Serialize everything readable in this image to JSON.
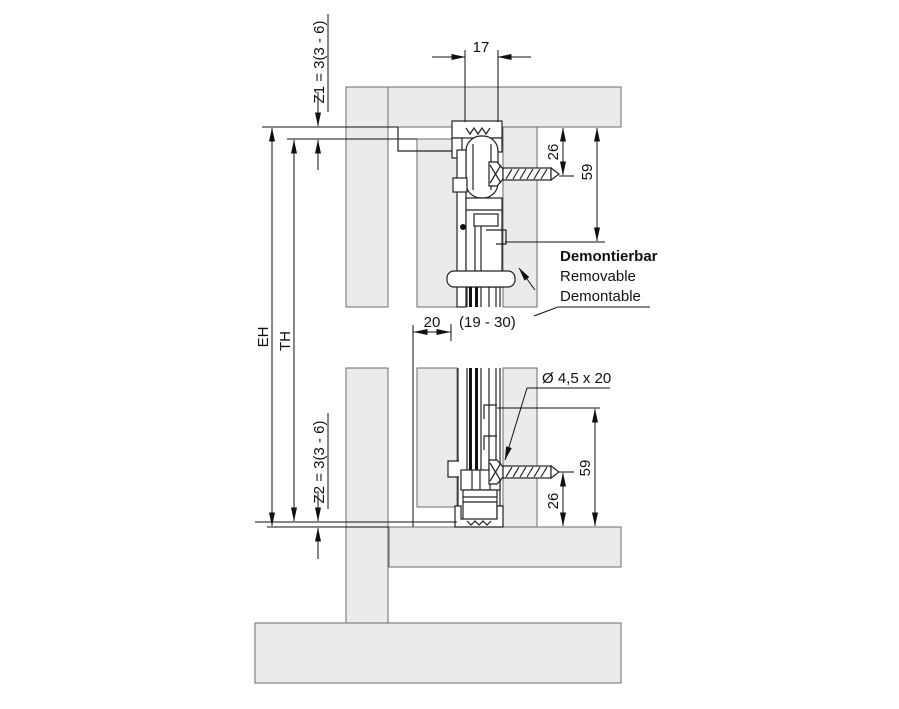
{
  "drawing": {
    "dim_track_width": "17",
    "dim_offset_26": "26",
    "dim_height_59": "59",
    "dim_gap_20": "20",
    "dim_gap_range": "(19 - 30)",
    "z1_label": "Z1 = 3(3 - 6)",
    "z2_label": "Z2 = 3(3 - 6)",
    "eh_label": "EH",
    "th_label": "TH",
    "screw_spec": "Ø 4,5 x 20",
    "note": {
      "de": "Demontierbar",
      "en": "Removable",
      "fr": "Demontable"
    },
    "colors": {
      "panel": "#ebebeb",
      "line": "#1c1c1c"
    }
  }
}
